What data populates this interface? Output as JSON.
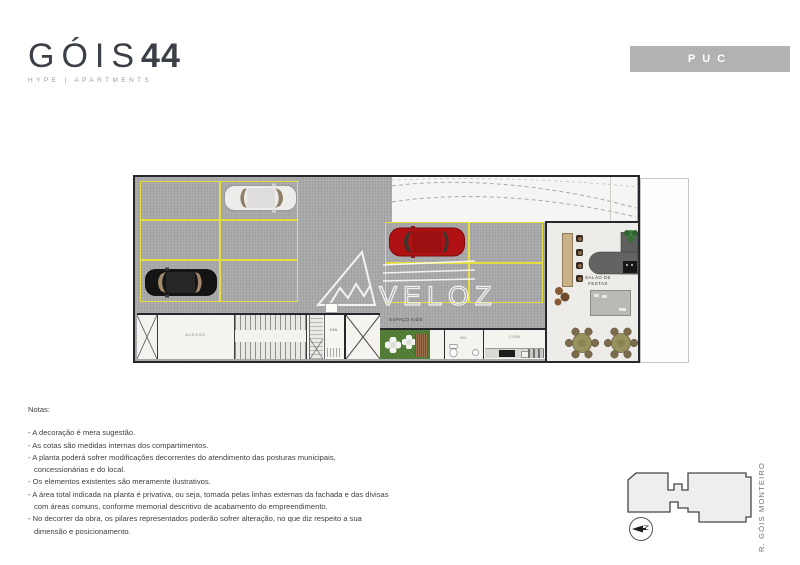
{
  "brand": {
    "name": "GÓIS",
    "number": "44",
    "tagline": "HYPE | APARTMENTS"
  },
  "badge": {
    "label": "PUC"
  },
  "floorplan": {
    "watermark": "VELOZ",
    "labels": {
      "salao_line1": "SALÃO DE",
      "salao_line2": "FESTAS",
      "espaco_kids": "ESPAÇO KIDS",
      "room_access": "ACESSO",
      "room_dml": "DML",
      "room_wc": "WC",
      "room_kitchen": "COPA"
    },
    "colors": {
      "parking_asphalt": "#a9a9ab",
      "parking_stripe_yellow": "#e3dd3e",
      "wall_dark": "#26272b",
      "car_white": "#ececea",
      "car_black": "#141414",
      "car_red": "#b01113",
      "kids_green": "#57823a",
      "brand_dark": "#3b3f46",
      "badge_gray": "#b2b2b3"
    }
  },
  "notes": {
    "title": "Notas:",
    "items": [
      "- A decoração é mera sugestão.",
      "- As cotas são medidas internas dos compartimentos.",
      "- A planta poderá sofrer modificações decorrentes do atendimento das posturas municipais, concessionárias e do local.",
      "- Os elementos existentes são meramente ilustrativos.",
      "- A área total indicada na planta é privativa, ou seja, tomada pelas linhas externas da fachada e das divisas com áreas comuns, conforme memorial descritivo de acabamento do empreendimento.",
      "- No decorrer da obra, os pilares representados poderão sofrer alteração, no que diz respeito a sua dimensão e posicionamento."
    ]
  },
  "sitekey": {
    "street": "R. GÓIS MONTEIRO",
    "north": "N"
  }
}
